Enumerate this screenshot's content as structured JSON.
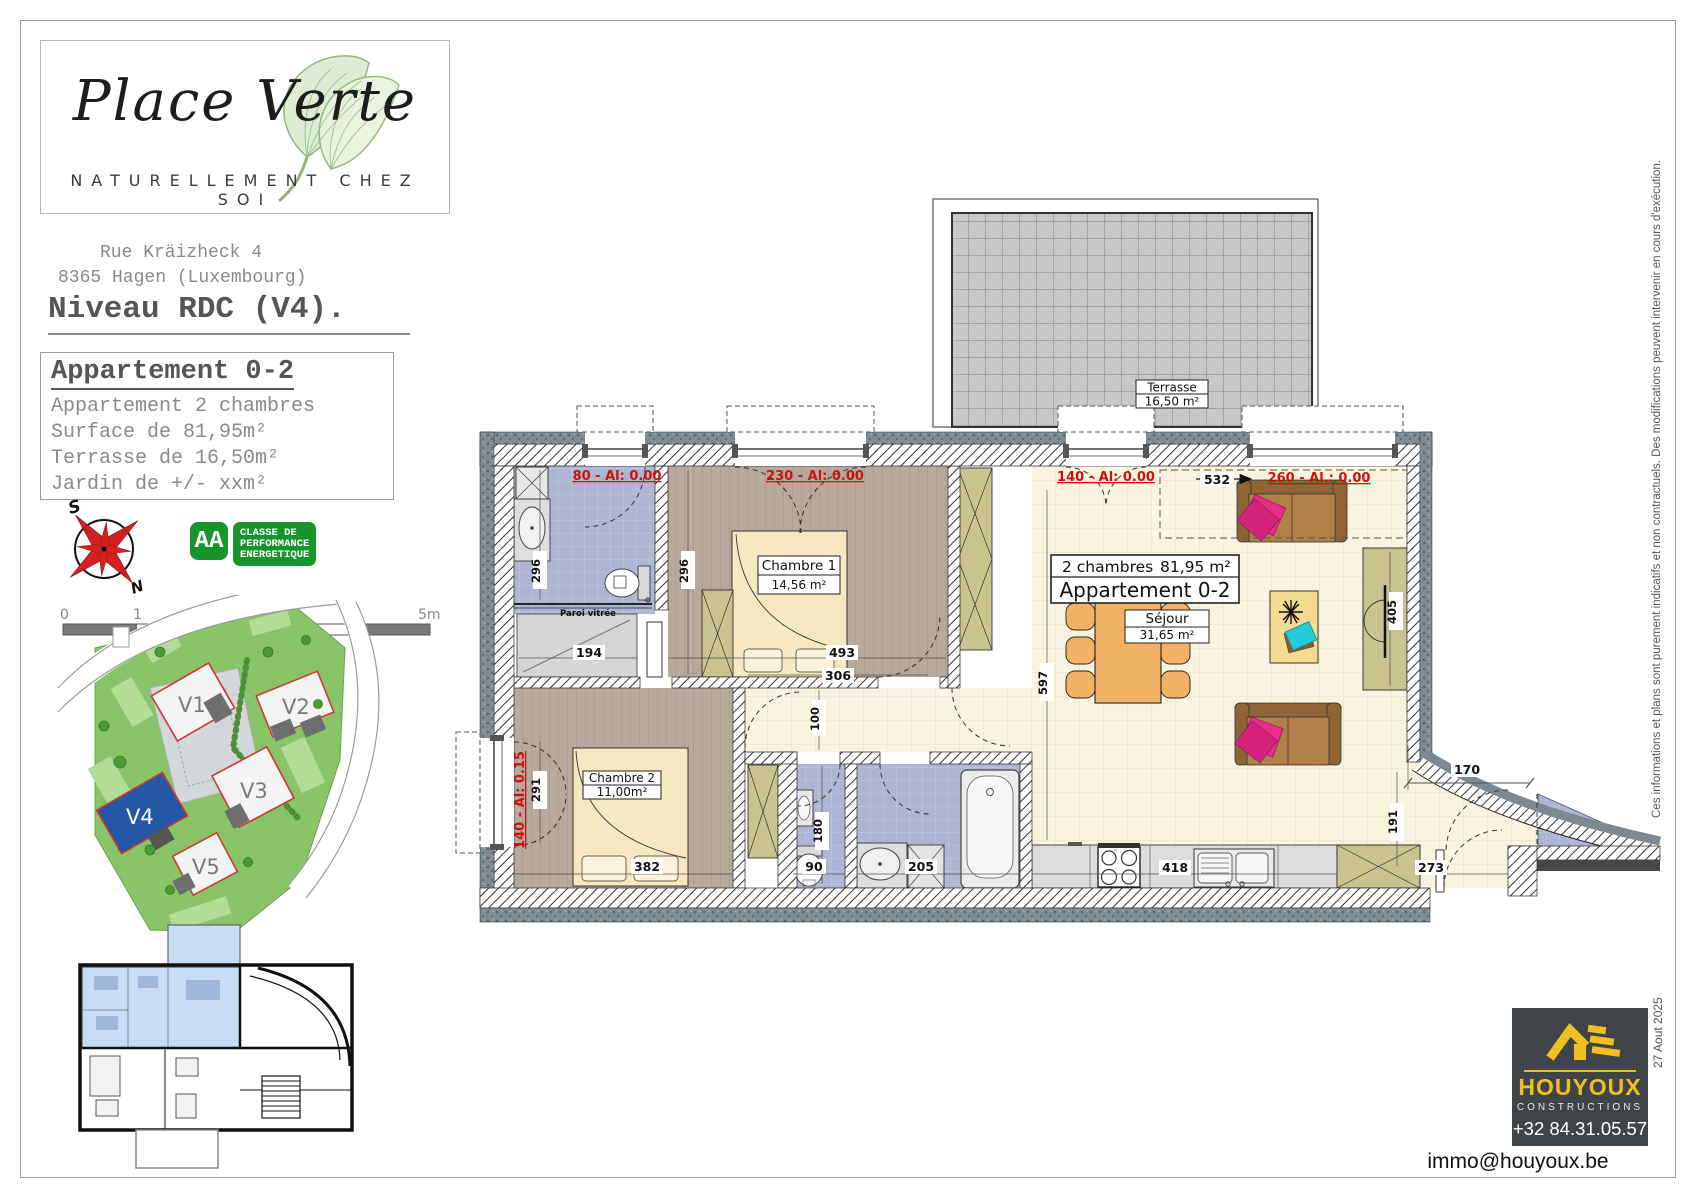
{
  "branding": {
    "title": "Place Verte",
    "tagline": "NATURELLEMENT CHEZ SOI"
  },
  "header": {
    "address1": "Rue Kräizheck 4",
    "address2": "8365 Hagen (Luxembourg)",
    "level": "Niveau RDC (V4)."
  },
  "apartment": {
    "title": "Appartement 0-2",
    "desc": "Appartement 2 chambres",
    "surface": "Surface de 81,95m²",
    "terrace": "Terrasse de 16,50m²",
    "garden": "Jardin de +/- xxm²"
  },
  "compass": {
    "south": "S",
    "north": "N"
  },
  "energy": {
    "rating": "AA",
    "line1": "CLASSE DE",
    "line2": "PERFORMANCE",
    "line3": "ENERGETIQUE"
  },
  "scalebar": {
    "t0": "0",
    "t1": "1",
    "t2": "2",
    "t3": "3",
    "t4": "4",
    "t5": "5m"
  },
  "siteplan": {
    "v1": "V1",
    "v2": "V2",
    "v3": "V3",
    "v4": "V4",
    "v5": "V5"
  },
  "plan": {
    "terrace_name": "Terrasse",
    "terrace_area": "16,50 m²",
    "unit_count": "2 chambres",
    "unit_area": "81,95 m²",
    "unit_name": "Appartement 0-2",
    "sejour_name": "Séjour",
    "sejour_area": "31,65 m²",
    "ch1_name": "Chambre 1",
    "ch1_area": "14,56 m²",
    "ch2_name": "Chambre 2",
    "ch2_area": "11,00m²",
    "paroi": "Paroi vitrée",
    "w80": "80 - Al: 0.00",
    "w230": "230 - Al: 0.00",
    "w140": "140 - Al: 0.00",
    "w260": "260 - Al.: 0.00",
    "w140b": "140 - Al: 0.15",
    "d296a": "296",
    "d296b": "296",
    "d194": "194",
    "d493": "493",
    "d532": "532",
    "d597": "597",
    "d405": "405",
    "d306": "306",
    "d100": "100",
    "d180": "180",
    "d291": "291",
    "d382": "382",
    "d90": "90",
    "d205": "205",
    "d418": "418",
    "d170": "170",
    "d191": "191",
    "d273": "273"
  },
  "builder": {
    "name": "HOUYOUX",
    "sub": "CONSTRUCTIONS",
    "phone": "+32 84.31.05.57",
    "email": "immo@houyoux.be"
  },
  "side": {
    "date": "27 Aout 2025",
    "disclaimer": "Ces informations et plans sont purement indicatifs et non contractuels.  Des modifications peuvent intervenir en cours d'exécution."
  }
}
